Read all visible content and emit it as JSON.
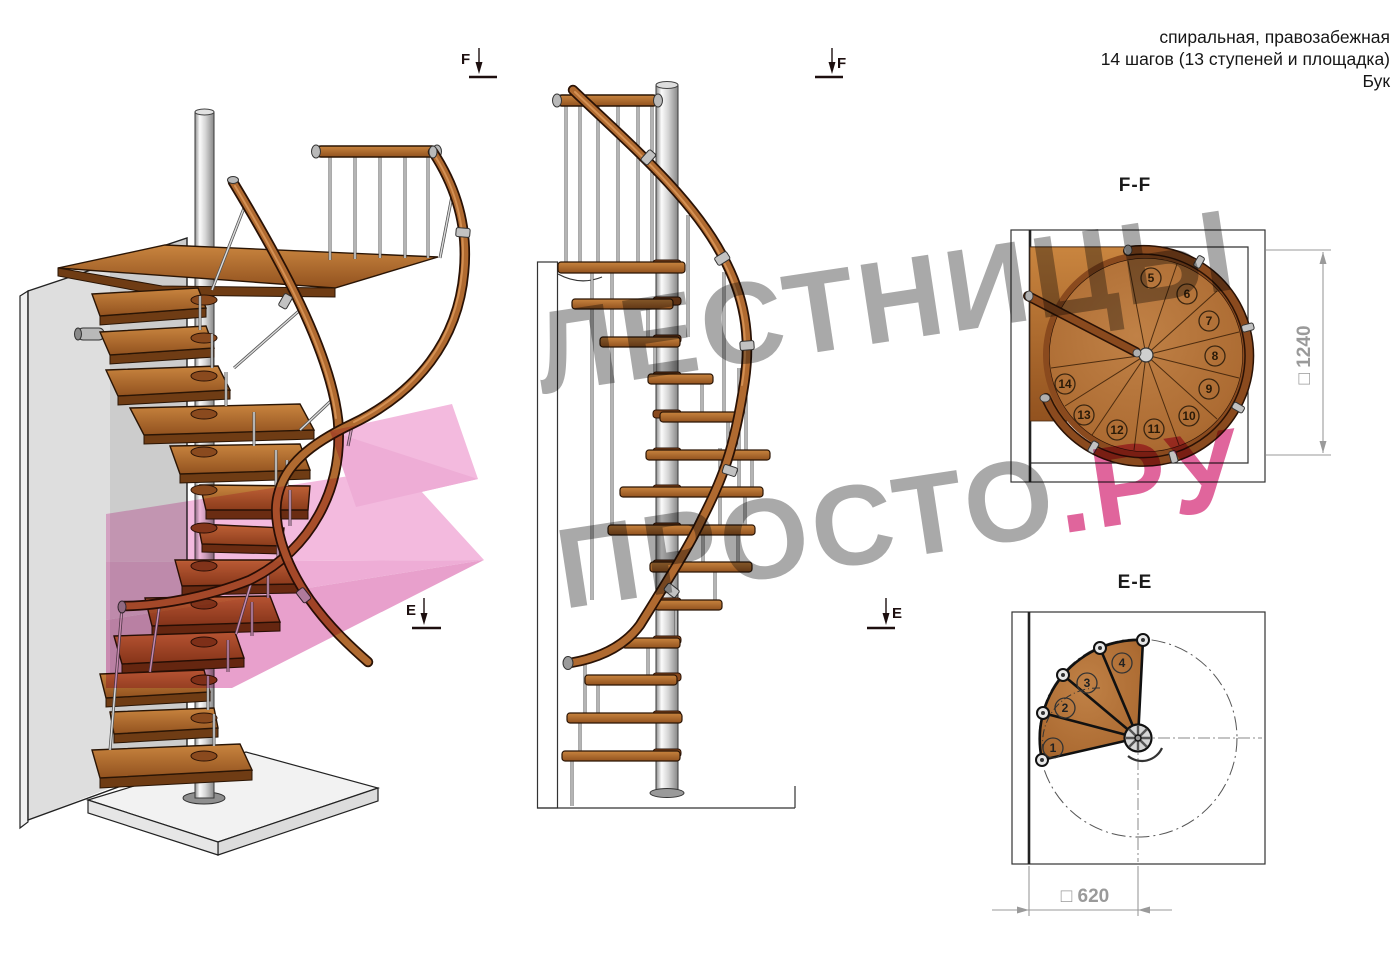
{
  "header": {
    "line1": "спиральная, правозабежная",
    "line2": "14 шагов (13 ступеней и площадка)",
    "line3": "Бук"
  },
  "watermark": {
    "line1": "ЛЕСТНИЦЫ",
    "line2_gray": "ПРОСТО",
    "line2_accent": ".РУ",
    "gray_color": "#a9a9a9",
    "accent_color": "#e0659c",
    "arrow_pink": "#f3bade"
  },
  "markers": {
    "f1": "F",
    "f2": "F",
    "e1": "E",
    "e2": "E"
  },
  "views": {
    "iso": {
      "name": "3d-view-of-spiral-staircase"
    },
    "side": {
      "name": "side-elevation-view"
    },
    "plan_ff": {
      "title": "F-F",
      "dimension": "□ 1240",
      "steps": [
        "5",
        "6",
        "7",
        "8",
        "9",
        "10",
        "11",
        "12",
        "13",
        "14"
      ]
    },
    "plan_ee": {
      "title": "E-E",
      "dimension": "□ 620",
      "steps": [
        "1",
        "2",
        "3",
        "4"
      ]
    }
  },
  "colors": {
    "wood": "#b5773c",
    "wood_dark": "#6f3c14",
    "rail": "#b06a30",
    "metal": "#c8c8c8",
    "line": "#333333",
    "dim_gray": "#9a9a9a"
  }
}
